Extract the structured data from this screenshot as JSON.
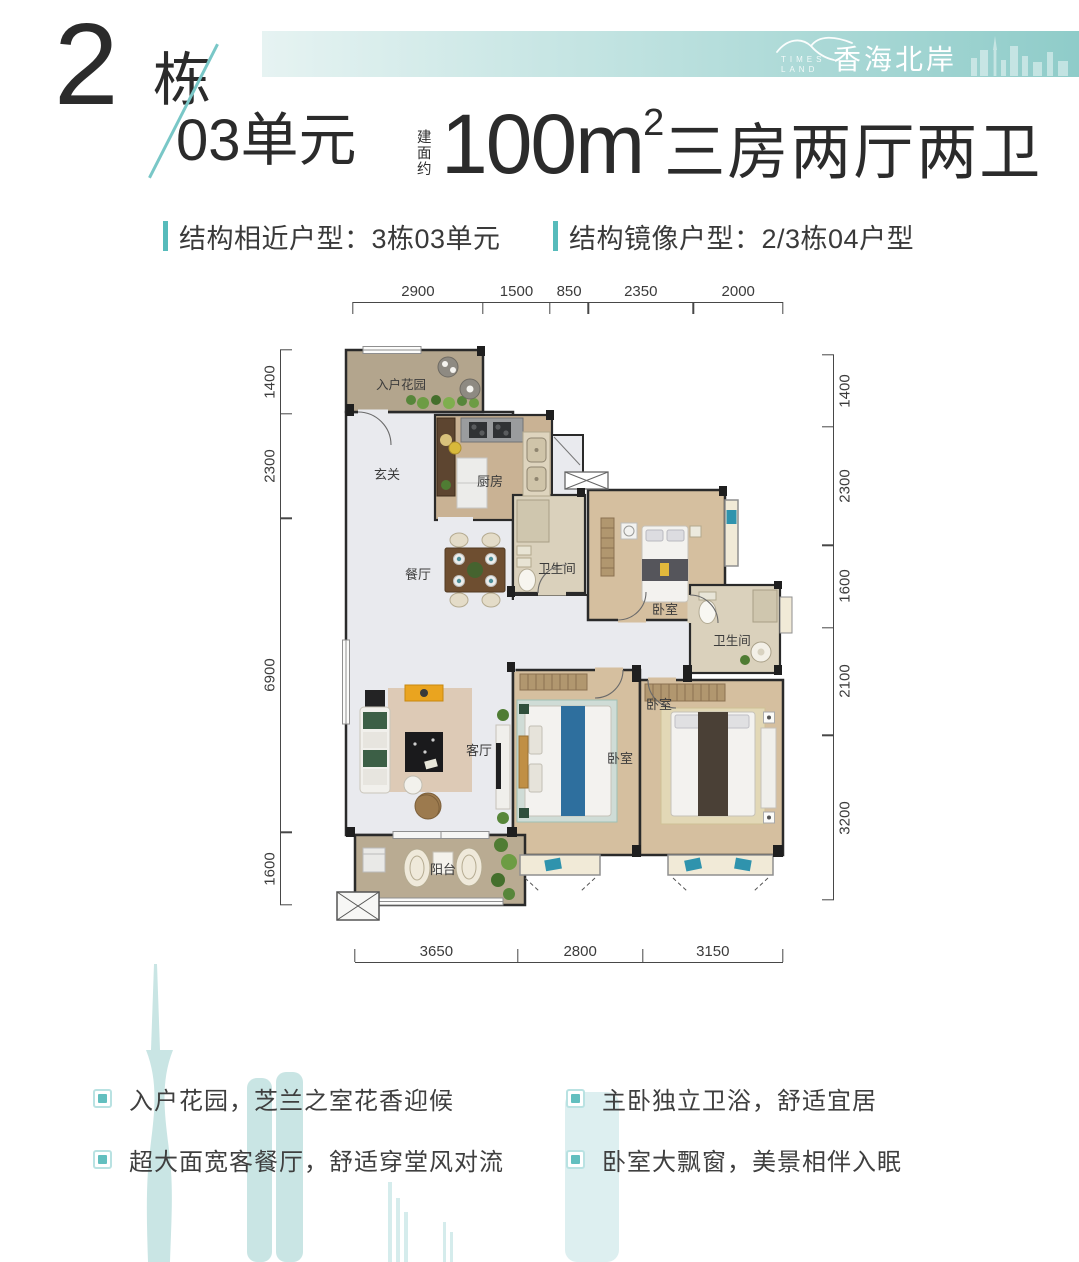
{
  "header": {
    "building_number": "2",
    "building_unit": "栋",
    "unit_label": "03单元",
    "area_prefix": "建面约",
    "area_value": "100m",
    "area_sup": "2",
    "headline_suffix": "三房两厅两卫",
    "brand": {
      "en_line1": "TIMES",
      "en_line2": "LAND",
      "cn": "香海北岸"
    },
    "similar_layout": "结构相近户型：3栋03单元",
    "mirror_layout": "结构镜像户型：2/3栋04户型"
  },
  "plan": {
    "rooms": [
      {
        "id": "entry-garden",
        "label": "入户花园"
      },
      {
        "id": "foyer",
        "label": "玄关"
      },
      {
        "id": "kitchen",
        "label": "厨房"
      },
      {
        "id": "dining",
        "label": "餐厅"
      },
      {
        "id": "bath-1",
        "label": "卫生间"
      },
      {
        "id": "bedroom-top",
        "label": "卧室"
      },
      {
        "id": "bath-master",
        "label": "卫生间"
      },
      {
        "id": "bedroom-master",
        "label": "卧室"
      },
      {
        "id": "bedroom-2",
        "label": "卧室"
      },
      {
        "id": "living",
        "label": "客厅"
      },
      {
        "id": "balcony",
        "label": "阳台"
      }
    ],
    "dims": {
      "top": [
        "2900",
        "1500",
        "850",
        "2350",
        "2000"
      ],
      "bottom": [
        "3650",
        "2800",
        "3150"
      ],
      "left": [
        "1400",
        "2300",
        "6900",
        "1600"
      ],
      "right": [
        "1400",
        "2300",
        "1600",
        "2100",
        "3200"
      ]
    }
  },
  "features": {
    "left": [
      "入户花园，芝兰之室花香迎候",
      "超大面宽客餐厅，舒适穿堂风对流"
    ],
    "right": [
      "主卧独立卫浴，舒适宜居",
      "卧室大飘窗，美景相伴入眠"
    ]
  },
  "colors": {
    "accent_teal": "#56bbbb",
    "bar_gradient_start": "#e6f3f2",
    "bar_gradient_end": "#8fccc9",
    "watermark": "#c9e5e4",
    "wall": "#2a2a2a"
  }
}
